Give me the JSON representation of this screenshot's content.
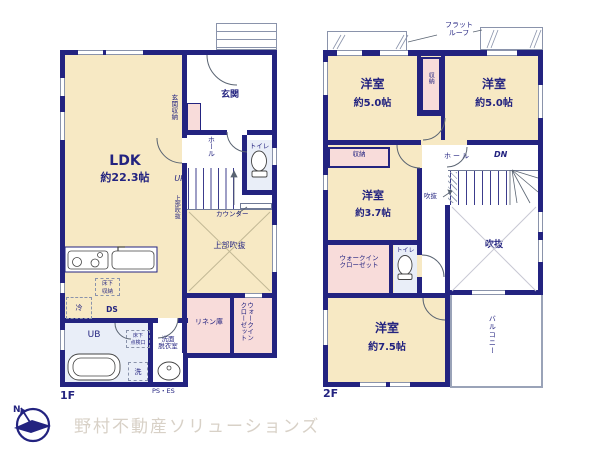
{
  "brand": {
    "logo": "野村不動産ソリューションズ",
    "compass_n": "N"
  },
  "colors": {
    "wall": "#232380",
    "room": "#f7e9c4",
    "closet": "#f8dcda",
    "wet": "#e9eef8"
  },
  "floor1": {
    "label": "1F",
    "ldk_name": "LDK",
    "ldk_size": "約22.3帖",
    "genkan": "玄関",
    "genkan_storage": "玄関収納",
    "hall": "ホール",
    "toilet": "トイレ",
    "up": "UP",
    "void_side": "上部吹抜",
    "counter": "カウンター",
    "void": "上部吹抜",
    "floor_storage_l1": "床下",
    "floor_storage_l2": "収納",
    "fridge": "冷",
    "ds": "DS",
    "ub": "UB",
    "hatch_l1": "床下",
    "hatch_l2": "点検口",
    "washroom_l1": "洗面",
    "washroom_l2": "脱衣室",
    "washer": "洗",
    "linen": "リネン庫",
    "wic_l1": "ウォークイン",
    "wic_l2": "クローゼット",
    "ps_es": "PS・ES"
  },
  "floor2": {
    "label": "2F",
    "flat_roof_l1": "フラット",
    "flat_roof_l2": "ルーフ",
    "bedroom_nw_name": "洋室",
    "bedroom_nw_size": "約5.0帖",
    "bedroom_ne_name": "洋室",
    "bedroom_ne_size": "約5.0帖",
    "closet_mid": "収納",
    "closet_w": "収納",
    "hall": "ホール",
    "dn": "DN",
    "void_small": "吹抜",
    "bedroom_w_name": "洋室",
    "bedroom_w_size": "約3.7帖",
    "wic_l1": "ウォークイン",
    "wic_l2": "クローゼット",
    "toilet": "トイレ",
    "void": "吹抜",
    "bedroom_s_name": "洋室",
    "bedroom_s_size": "約7.5帖",
    "balcony": "バルコニー"
  }
}
